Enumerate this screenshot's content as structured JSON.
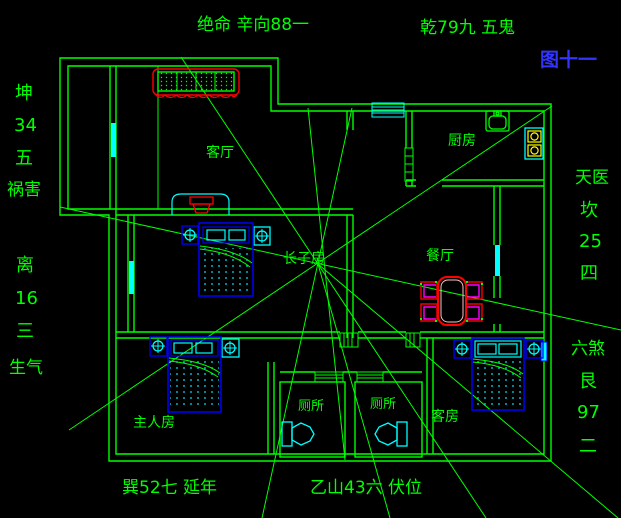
{
  "figure": {
    "top_left": "绝命 辛向88一",
    "top_right": "乾79九 五鬼",
    "figure_number": "图十一",
    "bottom_left": "巽52七 延年",
    "bottom_right": "乙山43六 伏位"
  },
  "left_labels": [
    "坤",
    "34",
    "五",
    "祸害",
    "离",
    "16",
    "三",
    "生气"
  ],
  "right_labels": [
    "天医",
    "坎",
    "25",
    "四",
    "六煞",
    "艮",
    "97",
    "二"
  ],
  "rooms": {
    "living_room": "客厅",
    "kitchen": "厨房",
    "dining_room": "餐厅",
    "eldest_son_room": "长子房",
    "master_bedroom": "主人房",
    "toilet_left": "厕所",
    "toilet_right": "厕所",
    "guest_room": "客房"
  },
  "colors": {
    "background": "#000000",
    "line_green": "#00ff00",
    "window_cyan": "#00ffff",
    "furniture_blue": "#0000ff",
    "accent_red": "#ff0000",
    "chair_magenta": "#ff00ff",
    "burner_yellow": "#ffff00",
    "figure_blue": "#3434ff"
  }
}
